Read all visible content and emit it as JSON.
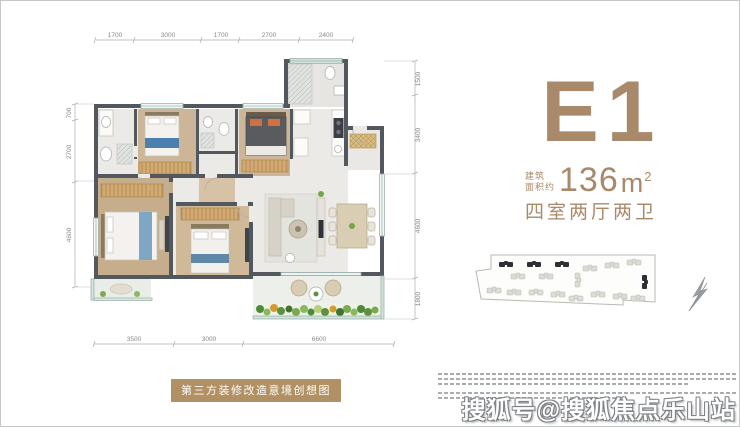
{
  "unit": {
    "code": "E1",
    "area_prefix_line1": "建筑",
    "area_prefix_line2": "面积约",
    "area_number": "136",
    "area_unit": "m",
    "area_exponent": "2",
    "rooms": "四室两厅两卫"
  },
  "caption": {
    "text": "第三方装修改造意境创想图"
  },
  "watermark": {
    "text": "搜狐号@搜狐焦点乐山站"
  },
  "floorplan": {
    "dims_top": [
      "1700",
      "3000",
      "1700",
      "2700",
      "2400"
    ],
    "dims_left": [
      "700",
      "2700",
      "4600"
    ],
    "dims_right": [
      "1500",
      "3400",
      "4600",
      "1800"
    ],
    "dims_bottom": [
      "3500",
      "3000",
      "6600"
    ]
  },
  "colors": {
    "accent": "#a8896a",
    "badge_bg": "#b19064",
    "wall": "#53575e",
    "wood_floor": "#cdb697",
    "tile_floor": "#eceae6",
    "window_teal": "#cfe3da",
    "plant_green": "#5d9140"
  }
}
